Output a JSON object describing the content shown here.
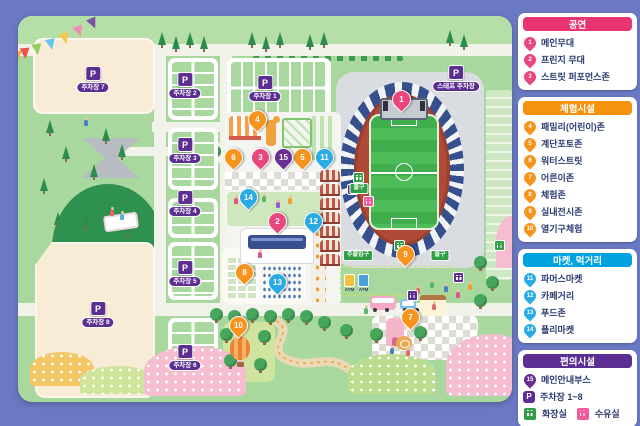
{
  "colors": {
    "background": "#6b79c4",
    "map_green": "#a8d89e",
    "pin_pink": "#e8477d",
    "pin_orange": "#f7941e",
    "pin_blue": "#2aabe4",
    "pin_purple": "#6a2d91",
    "header_pink": "#e8346f",
    "header_orange": "#f5930f",
    "header_blue": "#00a3df",
    "header_purple": "#5c2e91",
    "sign_green": "#2f9e44"
  },
  "legend": {
    "sections": [
      {
        "title": "공연",
        "items": [
          {
            "num": "1",
            "label": "메인무대"
          },
          {
            "num": "2",
            "label": "프린지 무대"
          },
          {
            "num": "3",
            "label": "스트릿 퍼포먼스존"
          }
        ]
      },
      {
        "title": "체험시설",
        "items": [
          {
            "num": "4",
            "label": "패밀리(어린이)존"
          },
          {
            "num": "5",
            "label": "계단포토존"
          },
          {
            "num": "6",
            "label": "워터스트릿"
          },
          {
            "num": "7",
            "label": "어른이존"
          },
          {
            "num": "8",
            "label": "체험존"
          },
          {
            "num": "9",
            "label": "실내전시존"
          },
          {
            "num": "10",
            "label": "열기구체험"
          }
        ]
      },
      {
        "title": "마켓, 먹거리",
        "items": [
          {
            "num": "11",
            "label": "파머스마켓"
          },
          {
            "num": "12",
            "label": "카페거리"
          },
          {
            "num": "13",
            "label": "푸드존"
          },
          {
            "num": "14",
            "label": "플리마켓"
          }
        ]
      },
      {
        "title": "편의시설",
        "items": [
          {
            "num": "15",
            "label": "메인안내부스"
          }
        ],
        "parking_item": {
          "icon": "P",
          "label": "주차장 1~8"
        },
        "facility_item": {
          "toilet_label": "화장실",
          "nursing_label": "수유실"
        }
      }
    ]
  },
  "map": {
    "p_letter": "P",
    "parking_badges": [
      {
        "label": "주차장 7"
      },
      {
        "label": "주차장 2"
      },
      {
        "label": "주차장 1"
      },
      {
        "label": "주차장 3"
      },
      {
        "label": "주차장 4"
      },
      {
        "label": "주차장 5"
      },
      {
        "label": "주차장 6"
      },
      {
        "label": "주차장 8"
      },
      {
        "label": "스태프 주차장"
      }
    ],
    "signs": [
      {
        "label": "출구"
      },
      {
        "label": "주출입구"
      },
      {
        "label": "출구"
      }
    ],
    "atm_label": "ATM",
    "markers": [
      {
        "num": "1"
      },
      {
        "num": "2"
      },
      {
        "num": "3"
      },
      {
        "num": "4"
      },
      {
        "num": "5"
      },
      {
        "num": "6"
      },
      {
        "num": "7"
      },
      {
        "num": "8"
      },
      {
        "num": "9"
      },
      {
        "num": "10"
      },
      {
        "num": "11"
      },
      {
        "num": "12"
      },
      {
        "num": "13"
      },
      {
        "num": "14"
      },
      {
        "num": "15"
      }
    ]
  }
}
